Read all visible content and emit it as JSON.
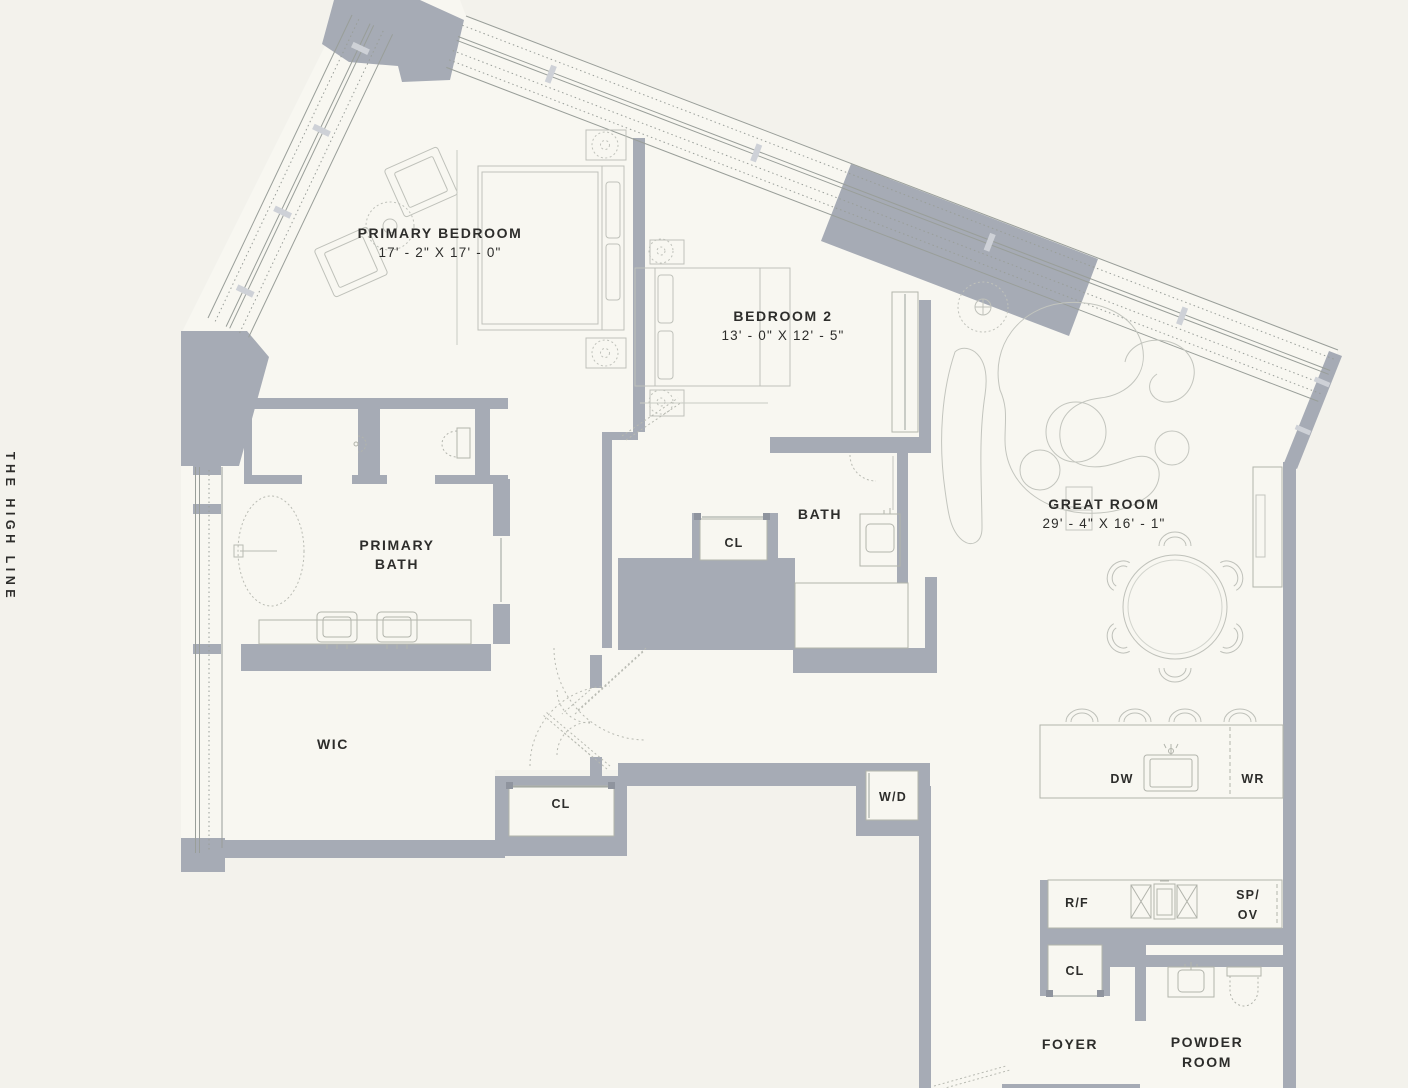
{
  "location_label": "THE HIGH LINE",
  "rooms": {
    "primary_bedroom": {
      "name": "PRIMARY BEDROOM",
      "dims": "17' - 2\" X 17' - 0\""
    },
    "bedroom_2": {
      "name": "BEDROOM 2",
      "dims": "13' - 0\" X 12' - 5\""
    },
    "great_room": {
      "name": "GREAT ROOM",
      "dims": "29' - 4\" X 16' - 1\""
    },
    "primary_bath": {
      "line1": "PRIMARY",
      "line2": "BATH"
    },
    "bath": {
      "name": "BATH"
    },
    "wic": {
      "name": "WIC"
    },
    "foyer": {
      "name": "FOYER"
    },
    "powder_room": {
      "line1": "POWDER",
      "line2": "ROOM"
    }
  },
  "fixtures": {
    "closet_bath": "CL",
    "closet_hall": "CL",
    "closet_foyer": "CL",
    "washer_dryer": "W/D",
    "dishwasher": "DW",
    "wine_refrigerator": "WR",
    "refrigerator_freezer": "R/F",
    "speed_oven_line1": "SP/",
    "speed_oven_line2": "OV"
  },
  "colors": {
    "background": "#f3f2ec",
    "floor": "#f8f7f1",
    "wall": "#a6abb5",
    "mullion": "#ced1d7",
    "window_line": "#999e99",
    "furniture_line": "#c3c5be",
    "fixture_line": "#b2b4ac",
    "text": "#2d2d2b"
  }
}
